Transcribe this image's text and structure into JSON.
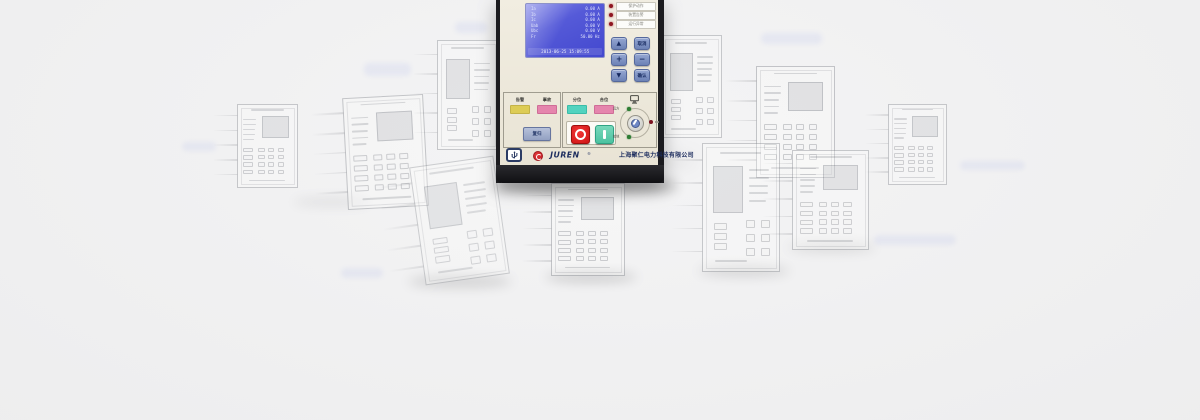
{
  "page": {
    "background": "#f0f0f1",
    "width": 1200,
    "height": 420
  },
  "device": {
    "name": "JUREN protection relay front panel",
    "panel_color": "#ece7da",
    "frame_color": "#1b1b1f",
    "lcd": {
      "bg": "#4d52d3",
      "timestamp": "2013-06-25 15:09:55",
      "rows": [
        {
          "label": "Ia",
          "value": "0.00 A"
        },
        {
          "label": "Ib",
          "value": "0.00 A"
        },
        {
          "label": "Ic",
          "value": "0.00 A"
        },
        {
          "label": "Uab",
          "value": "0.00 V"
        },
        {
          "label": "Ubc",
          "value": "0.00 V"
        },
        {
          "label": "Fr",
          "value": "50.00 Hz"
        }
      ]
    },
    "leds": [
      {
        "label": "保护动作",
        "color": "#8e1620"
      },
      {
        "label": "装置告警",
        "color": "#8e1620"
      },
      {
        "label": "运行异常",
        "color": "#8e1620"
      }
    ],
    "keypad": [
      {
        "label": "▲",
        "type": "arrow-up"
      },
      {
        "label": "取消",
        "type": "cancel"
      },
      {
        "label": "+",
        "type": "plus"
      },
      {
        "label": "−",
        "type": "minus"
      },
      {
        "label": "▼",
        "type": "arrow-down"
      },
      {
        "label": "确认",
        "type": "confirm"
      }
    ],
    "indicators": {
      "alarm": "告警",
      "fault": "事故",
      "open_position": "分位",
      "closed_position": "合位"
    },
    "indicator_colors": {
      "alarm": "#ddcc55",
      "fault": "#e585ad",
      "open_position": "#52d3bf",
      "closed_position": "#e585ad"
    },
    "buttons": {
      "reset": "复归",
      "trip": "O",
      "close": "I"
    },
    "selector": {
      "remote": "远方",
      "local": "就地"
    },
    "brand": {
      "logo": "JUREN",
      "reg": "®",
      "company": "上海聚仁电力科技有限公司",
      "logo_color": "#c21f28",
      "text_color": "#1c2c5e"
    }
  },
  "background": {
    "devices": [
      {
        "x": 237,
        "y": 104,
        "w": 61,
        "h": 84,
        "rot": 0,
        "opacity": 0.5,
        "variant": "a"
      },
      {
        "x": 345,
        "y": 96,
        "w": 81,
        "h": 112,
        "rot": -3,
        "opacity": 0.55,
        "variant": "a"
      },
      {
        "x": 437,
        "y": 40,
        "w": 62,
        "h": 110,
        "rot": 0,
        "opacity": 0.5,
        "variant": "b"
      },
      {
        "x": 417,
        "y": 161,
        "w": 85,
        "h": 119,
        "rot": -8,
        "opacity": 0.45,
        "variant": "b"
      },
      {
        "x": 551,
        "y": 183,
        "w": 74,
        "h": 93,
        "rot": 0,
        "opacity": 0.55,
        "variant": "a"
      },
      {
        "x": 661,
        "y": 35,
        "w": 61,
        "h": 103,
        "rot": 0,
        "opacity": 0.5,
        "variant": "b"
      },
      {
        "x": 756,
        "y": 66,
        "w": 79,
        "h": 112,
        "rot": 0,
        "opacity": 0.55,
        "variant": "a"
      },
      {
        "x": 702,
        "y": 143,
        "w": 78,
        "h": 129,
        "rot": 0,
        "opacity": 0.5,
        "variant": "b"
      },
      {
        "x": 792,
        "y": 150,
        "w": 77,
        "h": 100,
        "rot": 0,
        "opacity": 0.5,
        "variant": "a"
      },
      {
        "x": 888,
        "y": 104,
        "w": 59,
        "h": 81,
        "rot": 0,
        "opacity": 0.5,
        "variant": "a"
      }
    ],
    "smudges": [
      {
        "x": 455,
        "y": 22,
        "w": 32,
        "h": 11
      },
      {
        "x": 364,
        "y": 63,
        "w": 47,
        "h": 13
      },
      {
        "x": 182,
        "y": 142,
        "w": 34,
        "h": 9
      },
      {
        "x": 341,
        "y": 268,
        "w": 42,
        "h": 10
      },
      {
        "x": 761,
        "y": 33,
        "w": 61,
        "h": 11
      },
      {
        "x": 960,
        "y": 161,
        "w": 65,
        "h": 9
      },
      {
        "x": 874,
        "y": 235,
        "w": 82,
        "h": 10
      }
    ],
    "shadows": [
      {
        "x": 492,
        "y": 178,
        "w": 186,
        "h": 16,
        "opacity": 0.3
      },
      {
        "x": 545,
        "y": 272,
        "w": 92,
        "h": 10,
        "opacity": 0.16
      },
      {
        "x": 408,
        "y": 276,
        "w": 104,
        "h": 11,
        "opacity": 0.14
      },
      {
        "x": 698,
        "y": 266,
        "w": 92,
        "h": 10,
        "opacity": 0.13
      },
      {
        "x": 788,
        "y": 243,
        "w": 88,
        "h": 9,
        "opacity": 0.11
      },
      {
        "x": 292,
        "y": 198,
        "w": 80,
        "h": 8,
        "opacity": 0.08
      }
    ]
  }
}
